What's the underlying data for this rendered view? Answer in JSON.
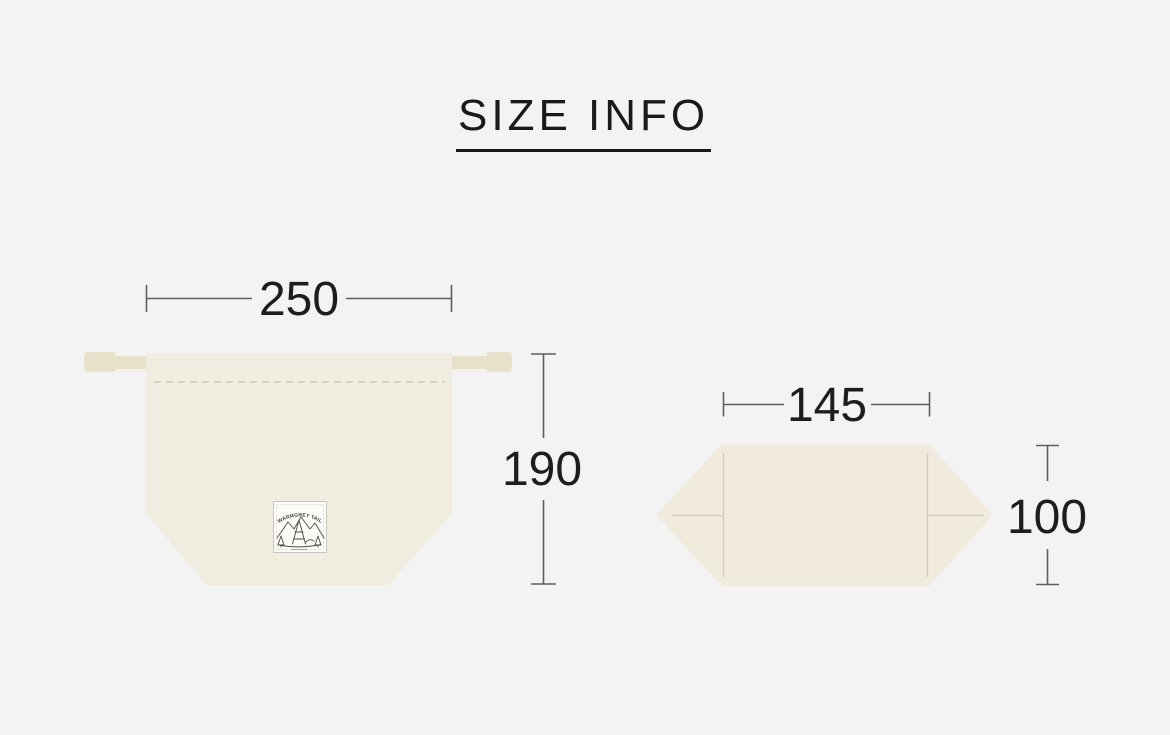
{
  "page": {
    "title": "SIZE INFO",
    "background": "#f3f3f4"
  },
  "figures": {
    "front": {
      "description": "drawstring bag front view",
      "width_value": "250",
      "height_value": "190",
      "label_brand": "WARMGREY TAIL",
      "colors": {
        "body": "#f0ecdf",
        "cord": "#e8e1c9",
        "stitch": "#d8d2bf",
        "label_bg": "#fcfbf7",
        "label_border": "#c9c7bd"
      }
    },
    "bottom": {
      "description": "bag folded flat bottom view",
      "width_value": "145",
      "height_value": "100",
      "colors": {
        "body": "#f0ebdd",
        "fold_line": "#d2ccb9"
      }
    }
  },
  "colors": {
    "text": "#1d1d1f",
    "dimension_line": "#5d5e61",
    "background": "#f3f3f4"
  }
}
